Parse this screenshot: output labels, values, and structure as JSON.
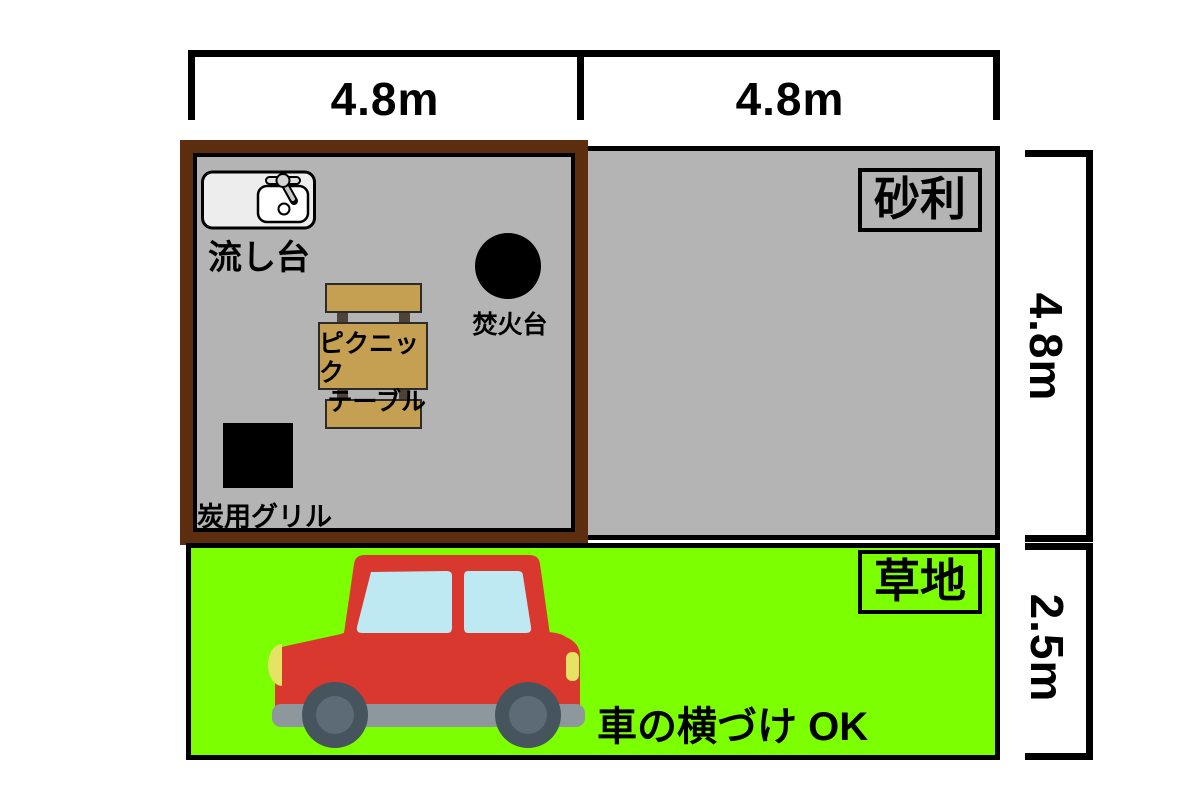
{
  "diagram_title": "campsite-layout",
  "dimensions": {
    "top_left": "4.8m",
    "top_right": "4.8m",
    "right_upper": "4.8m",
    "right_lower": "2.5m"
  },
  "areas": {
    "gravel": {
      "label": "砂利",
      "color": "#B4B4B4"
    },
    "grass": {
      "label": "草地",
      "color": "#7CFF00"
    }
  },
  "site": {
    "border_color": "#5C2D0E",
    "sink_label": "流し台",
    "fire_pit_label": "焚火台",
    "picnic_table_label_line1": "ピクニック",
    "picnic_table_label_line2": "テーブル",
    "grill_label": "炭用グリル"
  },
  "grass_note": "車の横づけ OK",
  "palette": {
    "car_body": "#D9382E",
    "car_window": "#BEE9F2",
    "wheel_outer": "#46545E",
    "wheel_inner": "#5C6B75",
    "bumper": "#8D979C",
    "lights": "#E6E263",
    "table_wood": "#C5A053"
  }
}
